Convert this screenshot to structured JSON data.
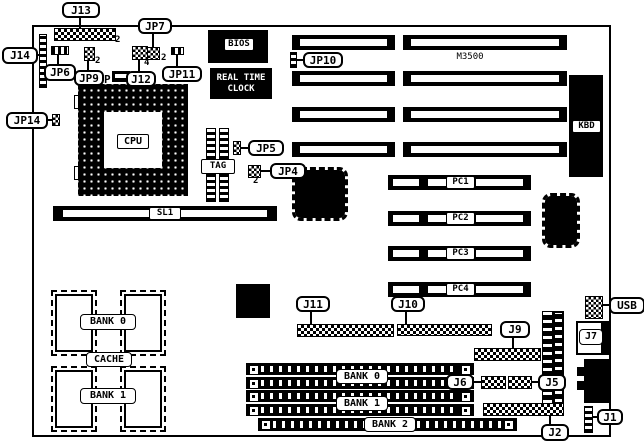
{
  "title": "Motherboard layout diagram",
  "board_model": "M3500",
  "labels": {
    "j13": "J13",
    "j14": "J14",
    "jp6": "JP6",
    "jp9": "JP9",
    "jp7": "JP7",
    "j12": "J12",
    "jp11": "JP11",
    "jp14": "JP14",
    "jp10": "JP10",
    "jp5": "JP5",
    "jp4": "JP4",
    "j11": "J11",
    "j10": "J10",
    "j9": "J9",
    "j6": "J6",
    "j5": "J5",
    "j2": "J2",
    "j1": "J1",
    "j7": "J7",
    "usb": "USB"
  },
  "chips": {
    "bios": "BIOS",
    "rtc_line1": "REAL TIME",
    "rtc_line2": "CLOCK",
    "cpu": "CPU",
    "tag": "TAG",
    "kbd": "KBD",
    "cache": "CACHE",
    "cache_bank0": "BANK 0",
    "cache_bank1": "BANK 1"
  },
  "slots": {
    "sl1": "SL1",
    "pc1": "PC1",
    "pc2": "PC2",
    "pc3": "PC3",
    "pc4": "PC4",
    "simm_bank0": "BANK 0",
    "simm_bank1": "BANK 1",
    "simm_bank2": "BANK 2"
  },
  "pin_numbers": {
    "j13": "2",
    "jp9": "2",
    "jp7": "2",
    "j12": "4",
    "jp4": "2"
  },
  "marks": {
    "p": "P"
  }
}
